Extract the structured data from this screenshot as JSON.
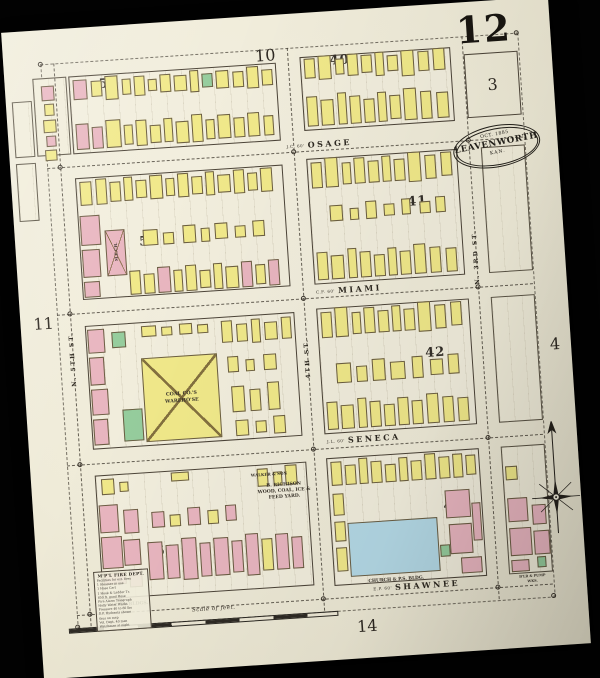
{
  "sheet": {
    "number": "12",
    "adjacent": {
      "top": "10",
      "top_right": "3",
      "left": "11",
      "right": "4",
      "bottom": "14"
    },
    "stamp": {
      "date": "OCT. 1885",
      "city": "LEAVENWORTH",
      "state": "KAN."
    },
    "scale_label": "Scale of feet."
  },
  "colors": {
    "paper": "#f0ecda",
    "ink": "#3c362d",
    "frame_black": "#020202",
    "building_frame_yellow": "#f1e98a",
    "building_brick_pink": "#e9b6c0",
    "building_special_green": "#96cd9d",
    "building_stone_blue": "#b4d9e6"
  },
  "legend": {
    "title": "M'P'L FIRE DEPT.",
    "lines": [
      "Facilities for ext. fires",
      "1 Steamer in use",
      "1 Hose Cart",
      "1 Hook & Ladder Tr.",
      "850 ft. good Hose",
      "Fire Alarm Telegraph",
      "Holly Water Works",
      "Pressure 40 to 80 lbs",
      "D.P. Hydrants shown",
      "thus on map",
      "Vol. Dept. 40 men",
      "Watchman at night"
    ]
  },
  "streets": {
    "horizontal": [
      {
        "name": "OSAGE",
        "prefix": "J.C. 60'",
        "cx": 310,
        "cy": 132,
        "y": 138
      },
      {
        "name": "MIAMI",
        "prefix": "C.F. 60'",
        "cx": 330,
        "cy": 279,
        "y": 285
      },
      {
        "name": "SENECA",
        "prefix": "J.L. 60'",
        "cx": 335,
        "cy": 429,
        "y": 436
      },
      {
        "name": "SHAWNEE",
        "prefix": "E.P. 60'",
        "cx": 378,
        "cy": 579,
        "y": 586
      }
    ],
    "vertical": [
      {
        "name": "N. 5TH ST.",
        "x": 50,
        "cy": 330
      },
      {
        "name": "4TH ST.",
        "x": 284,
        "cy": 345
      },
      {
        "name": "N. 3RD ST.",
        "x": 459,
        "cy": 255
      }
    ]
  },
  "blocks": [
    {
      "n": "53",
      "x": 64,
      "y": 48,
      "w": 208,
      "h": 78,
      "nx": 104,
      "ny": 58
    },
    {
      "n": "40",
      "x": 296,
      "y": 44,
      "w": 151,
      "h": 74,
      "nx": 336,
      "ny": 50
    },
    {
      "n": "52",
      "x": 64,
      "y": 150,
      "w": 208,
      "h": 122,
      "nx": 134,
      "ny": 218
    },
    {
      "n": "41",
      "x": 296,
      "y": 146,
      "w": 151,
      "h": 126,
      "nx": 404,
      "ny": 196
    },
    {
      "n": "51",
      "x": 64,
      "y": 298,
      "w": 210,
      "h": 124,
      "nx": 130,
      "ny": 378
    },
    {
      "n": "42",
      "x": 296,
      "y": 296,
      "w": 153,
      "h": 126,
      "nx": 412,
      "ny": 348
    },
    {
      "n": "50",
      "x": 64,
      "y": 448,
      "w": 212,
      "h": 124,
      "nx": 130,
      "ny": 528
    },
    {
      "n": "43",
      "x": 296,
      "y": 446,
      "w": 153,
      "h": 128,
      "nx": 420,
      "ny": 502
    }
  ],
  "partial_blocks": [
    {
      "x": 471,
      "y": 146,
      "w": 44,
      "h": 126
    },
    {
      "x": 471,
      "y": 296,
      "w": 44,
      "h": 126
    },
    {
      "x": 471,
      "y": 446,
      "w": 44,
      "h": 128
    },
    {
      "x": 28,
      "y": 48,
      "w": 34,
      "h": 78
    },
    {
      "x": 6,
      "y": 70,
      "w": 20,
      "h": 56
    },
    {
      "x": 6,
      "y": 132,
      "w": 20,
      "h": 58
    }
  ],
  "buildings": [
    [
      36,
      56,
      13,
      15,
      "p"
    ],
    [
      38,
      74,
      10,
      12,
      "y"
    ],
    [
      36,
      90,
      13,
      13,
      "y"
    ],
    [
      38,
      106,
      10,
      11,
      "p"
    ],
    [
      36,
      120,
      12,
      11,
      "y"
    ],
    [
      68,
      52,
      14,
      20,
      "p"
    ],
    [
      86,
      54,
      11,
      16,
      "y"
    ],
    [
      100,
      50,
      13,
      24,
      "y"
    ],
    [
      117,
      54,
      9,
      16,
      "y"
    ],
    [
      129,
      52,
      11,
      20,
      "y"
    ],
    [
      143,
      56,
      9,
      12,
      "y"
    ],
    [
      155,
      52,
      11,
      18,
      "y"
    ],
    [
      169,
      54,
      13,
      16,
      "y"
    ],
    [
      185,
      50,
      9,
      22,
      "y"
    ],
    [
      197,
      54,
      11,
      14,
      "g"
    ],
    [
      211,
      52,
      13,
      18,
      "y"
    ],
    [
      228,
      54,
      11,
      16,
      "y"
    ],
    [
      242,
      50,
      12,
      22,
      "y"
    ],
    [
      257,
      54,
      11,
      16,
      "y"
    ],
    [
      68,
      96,
      13,
      26,
      "p"
    ],
    [
      84,
      100,
      11,
      22,
      "p"
    ],
    [
      98,
      94,
      15,
      28,
      "y"
    ],
    [
      116,
      100,
      9,
      20,
      "y"
    ],
    [
      128,
      96,
      11,
      26,
      "y"
    ],
    [
      142,
      102,
      11,
      18,
      "y"
    ],
    [
      156,
      96,
      9,
      24,
      "y"
    ],
    [
      168,
      100,
      13,
      22,
      "y"
    ],
    [
      184,
      94,
      11,
      28,
      "y"
    ],
    [
      198,
      100,
      9,
      20,
      "y"
    ],
    [
      210,
      96,
      13,
      24,
      "y"
    ],
    [
      226,
      100,
      11,
      20,
      "y"
    ],
    [
      240,
      96,
      12,
      24,
      "y"
    ],
    [
      256,
      100,
      10,
      20,
      "y"
    ],
    [
      300,
      46,
      11,
      20,
      "y"
    ],
    [
      314,
      44,
      13,
      24,
      "y"
    ],
    [
      331,
      48,
      9,
      16,
      "y"
    ],
    [
      343,
      44,
      11,
      22,
      "y"
    ],
    [
      357,
      46,
      11,
      18,
      "y"
    ],
    [
      371,
      44,
      9,
      24,
      "y"
    ],
    [
      383,
      48,
      11,
      16,
      "y"
    ],
    [
      397,
      44,
      13,
      26,
      "y"
    ],
    [
      414,
      46,
      11,
      20,
      "y"
    ],
    [
      429,
      44,
      12,
      22,
      "y"
    ],
    [
      300,
      84,
      11,
      30,
      "y"
    ],
    [
      314,
      88,
      13,
      26,
      "y"
    ],
    [
      331,
      82,
      9,
      32,
      "y"
    ],
    [
      343,
      86,
      11,
      28,
      "y"
    ],
    [
      357,
      90,
      11,
      24,
      "y"
    ],
    [
      371,
      84,
      9,
      30,
      "y"
    ],
    [
      383,
      88,
      11,
      24,
      "y"
    ],
    [
      397,
      82,
      13,
      32,
      "y"
    ],
    [
      414,
      86,
      11,
      28,
      "y"
    ],
    [
      430,
      88,
      12,
      26,
      "y"
    ],
    [
      68,
      154,
      12,
      24,
      "y"
    ],
    [
      84,
      152,
      11,
      26,
      "y"
    ],
    [
      98,
      156,
      11,
      20,
      "y"
    ],
    [
      112,
      152,
      9,
      24,
      "y"
    ],
    [
      124,
      156,
      11,
      18,
      "y"
    ],
    [
      138,
      152,
      13,
      24,
      "y"
    ],
    [
      154,
      156,
      9,
      18,
      "y"
    ],
    [
      166,
      152,
      11,
      24,
      "y"
    ],
    [
      180,
      156,
      11,
      18,
      "y"
    ],
    [
      194,
      152,
      9,
      24,
      "y"
    ],
    [
      206,
      156,
      13,
      18,
      "y"
    ],
    [
      222,
      152,
      11,
      24,
      "y"
    ],
    [
      236,
      156,
      10,
      18,
      "y"
    ],
    [
      249,
      152,
      12,
      24,
      "y"
    ],
    [
      66,
      188,
      20,
      30,
      "p"
    ],
    [
      66,
      222,
      18,
      28,
      "p"
    ],
    [
      66,
      254,
      16,
      16,
      "p"
    ],
    [
      90,
      204,
      20,
      46,
      "p",
      1
    ],
    [
      112,
      246,
      11,
      24,
      "y"
    ],
    [
      126,
      250,
      11,
      20,
      "y"
    ],
    [
      140,
      244,
      13,
      26,
      "p"
    ],
    [
      156,
      248,
      9,
      22,
      "y"
    ],
    [
      168,
      244,
      11,
      26,
      "y"
    ],
    [
      182,
      250,
      11,
      18,
      "y"
    ],
    [
      196,
      244,
      9,
      26,
      "y"
    ],
    [
      208,
      248,
      13,
      22,
      "y"
    ],
    [
      224,
      244,
      11,
      26,
      "p"
    ],
    [
      238,
      248,
      10,
      20,
      "y"
    ],
    [
      251,
      244,
      11,
      26,
      "p"
    ],
    [
      128,
      206,
      15,
      16,
      "y"
    ],
    [
      148,
      210,
      11,
      12,
      "y"
    ],
    [
      168,
      204,
      13,
      18,
      "y"
    ],
    [
      186,
      208,
      9,
      14,
      "y"
    ],
    [
      200,
      204,
      13,
      16,
      "y"
    ],
    [
      220,
      208,
      11,
      12,
      "y"
    ],
    [
      238,
      204,
      12,
      16,
      "y"
    ],
    [
      300,
      150,
      11,
      26,
      "y"
    ],
    [
      314,
      146,
      13,
      30,
      "y"
    ],
    [
      331,
      152,
      9,
      22,
      "y"
    ],
    [
      343,
      148,
      11,
      26,
      "y"
    ],
    [
      357,
      152,
      11,
      22,
      "y"
    ],
    [
      371,
      148,
      9,
      26,
      "y"
    ],
    [
      383,
      152,
      11,
      22,
      "y"
    ],
    [
      397,
      146,
      13,
      30,
      "y"
    ],
    [
      414,
      150,
      11,
      24,
      "y"
    ],
    [
      430,
      148,
      11,
      24,
      "y"
    ],
    [
      300,
      240,
      11,
      28,
      "y"
    ],
    [
      314,
      244,
      13,
      24,
      "y"
    ],
    [
      331,
      238,
      9,
      30,
      "y"
    ],
    [
      343,
      242,
      11,
      26,
      "y"
    ],
    [
      357,
      246,
      11,
      22,
      "y"
    ],
    [
      371,
      240,
      9,
      28,
      "y"
    ],
    [
      383,
      244,
      11,
      24,
      "y"
    ],
    [
      397,
      238,
      12,
      30,
      "y"
    ],
    [
      413,
      242,
      11,
      26,
      "y"
    ],
    [
      429,
      244,
      11,
      24,
      "y"
    ],
    [
      316,
      194,
      13,
      16,
      "y"
    ],
    [
      336,
      198,
      9,
      12,
      "y"
    ],
    [
      352,
      192,
      11,
      18,
      "y"
    ],
    [
      370,
      196,
      11,
      12,
      "y"
    ],
    [
      388,
      192,
      9,
      16,
      "y"
    ],
    [
      406,
      196,
      11,
      12,
      "y"
    ],
    [
      422,
      192,
      10,
      16,
      "y"
    ],
    [
      118,
      334,
      76,
      84,
      "y",
      1
    ],
    [
      96,
      384,
      20,
      32,
      "g"
    ],
    [
      90,
      306,
      14,
      16,
      "g"
    ],
    [
      66,
      302,
      17,
      24,
      "p"
    ],
    [
      66,
      330,
      15,
      28,
      "p"
    ],
    [
      66,
      362,
      17,
      26,
      "p"
    ],
    [
      66,
      392,
      15,
      26,
      "p"
    ],
    [
      120,
      302,
      15,
      11,
      "y"
    ],
    [
      140,
      304,
      11,
      9,
      "y"
    ],
    [
      158,
      302,
      13,
      11,
      "y"
    ],
    [
      176,
      304,
      11,
      9,
      "y"
    ],
    [
      200,
      302,
      11,
      22,
      "y"
    ],
    [
      215,
      306,
      11,
      18,
      "y"
    ],
    [
      230,
      302,
      9,
      24,
      "y"
    ],
    [
      243,
      306,
      13,
      18,
      "y"
    ],
    [
      260,
      302,
      10,
      22,
      "y"
    ],
    [
      204,
      338,
      11,
      16,
      "y"
    ],
    [
      222,
      342,
      9,
      12,
      "y"
    ],
    [
      240,
      338,
      13,
      16,
      "y"
    ],
    [
      206,
      368,
      13,
      26,
      "y"
    ],
    [
      224,
      372,
      11,
      22,
      "y"
    ],
    [
      242,
      366,
      12,
      28,
      "y"
    ],
    [
      208,
      402,
      13,
      16,
      "y"
    ],
    [
      228,
      404,
      11,
      12,
      "y"
    ],
    [
      246,
      400,
      12,
      18,
      "y"
    ],
    [
      300,
      300,
      11,
      26,
      "y"
    ],
    [
      314,
      296,
      13,
      30,
      "y"
    ],
    [
      331,
      302,
      9,
      22,
      "y"
    ],
    [
      343,
      298,
      11,
      26,
      "y"
    ],
    [
      357,
      302,
      11,
      22,
      "y"
    ],
    [
      371,
      298,
      9,
      26,
      "y"
    ],
    [
      383,
      302,
      11,
      22,
      "y"
    ],
    [
      397,
      296,
      13,
      30,
      "y"
    ],
    [
      414,
      300,
      11,
      24,
      "y"
    ],
    [
      430,
      298,
      11,
      24,
      "y"
    ],
    [
      312,
      352,
      15,
      20,
      "y"
    ],
    [
      332,
      356,
      11,
      16,
      "y"
    ],
    [
      348,
      350,
      13,
      22,
      "y"
    ],
    [
      366,
      354,
      15,
      18,
      "y"
    ],
    [
      388,
      350,
      11,
      22,
      "y"
    ],
    [
      406,
      354,
      13,
      16,
      "y"
    ],
    [
      424,
      350,
      11,
      20,
      "y"
    ],
    [
      300,
      390,
      11,
      28,
      "y"
    ],
    [
      314,
      394,
      13,
      24,
      "y"
    ],
    [
      331,
      388,
      9,
      30,
      "y"
    ],
    [
      343,
      392,
      11,
      26,
      "y"
    ],
    [
      357,
      396,
      11,
      22,
      "y"
    ],
    [
      371,
      390,
      11,
      28,
      "y"
    ],
    [
      385,
      394,
      11,
      24,
      "y"
    ],
    [
      400,
      388,
      12,
      30,
      "y"
    ],
    [
      416,
      392,
      11,
      26,
      "y"
    ],
    [
      431,
      394,
      11,
      24,
      "y"
    ],
    [
      70,
      452,
      13,
      16,
      "y"
    ],
    [
      88,
      456,
      9,
      10,
      "y"
    ],
    [
      140,
      450,
      18,
      9,
      "y"
    ],
    [
      226,
      452,
      11,
      18,
      "y"
    ],
    [
      242,
      456,
      9,
      14,
      "y"
    ],
    [
      254,
      450,
      12,
      20,
      "y"
    ],
    [
      66,
      478,
      19,
      28,
      "p"
    ],
    [
      66,
      510,
      21,
      32,
      "p"
    ],
    [
      90,
      484,
      15,
      24,
      "p"
    ],
    [
      88,
      514,
      17,
      26,
      "p"
    ],
    [
      66,
      546,
      23,
      12,
      "p"
    ],
    [
      92,
      544,
      13,
      18,
      "p"
    ],
    [
      118,
      488,
      13,
      16,
      "p"
    ],
    [
      136,
      492,
      11,
      12,
      "y"
    ],
    [
      154,
      486,
      13,
      18,
      "p"
    ],
    [
      174,
      490,
      11,
      14,
      "y"
    ],
    [
      192,
      486,
      11,
      16,
      "p"
    ],
    [
      112,
      518,
      15,
      38,
      "p"
    ],
    [
      130,
      522,
      13,
      34,
      "p"
    ],
    [
      146,
      516,
      15,
      42,
      "p"
    ],
    [
      164,
      522,
      11,
      34,
      "p"
    ],
    [
      178,
      518,
      15,
      38,
      "p"
    ],
    [
      196,
      522,
      11,
      32,
      "p"
    ],
    [
      210,
      516,
      13,
      42,
      "p"
    ],
    [
      226,
      522,
      11,
      32,
      "y"
    ],
    [
      240,
      518,
      13,
      36,
      "p"
    ],
    [
      256,
      522,
      11,
      32,
      "p"
    ],
    [
      300,
      450,
      11,
      24,
      "y"
    ],
    [
      314,
      454,
      11,
      20,
      "y"
    ],
    [
      328,
      448,
      9,
      26,
      "y"
    ],
    [
      340,
      452,
      11,
      22,
      "y"
    ],
    [
      354,
      456,
      11,
      18,
      "y"
    ],
    [
      368,
      450,
      9,
      24,
      "y"
    ],
    [
      380,
      454,
      11,
      20,
      "y"
    ],
    [
      394,
      448,
      11,
      26,
      "y"
    ],
    [
      408,
      452,
      11,
      22,
      "y"
    ],
    [
      422,
      450,
      10,
      24,
      "y"
    ],
    [
      435,
      452,
      10,
      20,
      "y"
    ],
    [
      300,
      482,
      11,
      22,
      "y"
    ],
    [
      300,
      510,
      11,
      20,
      "y"
    ],
    [
      300,
      536,
      11,
      24,
      "y"
    ],
    [
      313,
      512,
      90,
      54,
      "b"
    ],
    [
      412,
      486,
      25,
      28,
      "p"
    ],
    [
      414,
      520,
      23,
      30,
      "p"
    ],
    [
      438,
      500,
      9,
      38,
      "p"
    ],
    [
      424,
      554,
      21,
      16,
      "p"
    ],
    [
      404,
      540,
      10,
      12,
      "g"
    ],
    [
      474,
      466,
      12,
      14,
      "y"
    ],
    [
      474,
      498,
      20,
      24,
      "p"
    ],
    [
      474,
      528,
      22,
      28,
      "p"
    ],
    [
      498,
      506,
      14,
      20,
      "p"
    ],
    [
      498,
      532,
      16,
      24,
      "p"
    ],
    [
      474,
      560,
      18,
      12,
      "p"
    ],
    [
      500,
      558,
      9,
      11,
      "g"
    ]
  ],
  "annotations": [
    {
      "t": "WALKER & SON",
      "x": 238,
      "y": 458,
      "s": 4
    },
    {
      "t": "B. RICHISON",
      "x": 252,
      "y": 470,
      "s": 4.6
    },
    {
      "t": "WOOD, COAL, ICE &",
      "x": 252,
      "y": 476,
      "s": 4.6
    },
    {
      "t": "FEED YARD.",
      "x": 252,
      "y": 482,
      "s": 4.6
    },
    {
      "t": "CITY BLDGS.",
      "x": 92,
      "y": 579,
      "s": 4.6
    },
    {
      "t": "COAL CO.'S",
      "x": 156,
      "y": 372,
      "s": 4.8
    },
    {
      "t": "WAREHO'SE",
      "x": 156,
      "y": 379,
      "s": 4.8
    },
    {
      "t": "M.E.CH.",
      "x": 100,
      "y": 226,
      "s": 4,
      "r": -90
    },
    {
      "t": "CHURCH & P.S. BLDG.",
      "x": 358,
      "y": 572,
      "s": 4.4
    },
    {
      "t": "B'LR & PUMP",
      "x": 494,
      "y": 577,
      "s": 3.4
    },
    {
      "t": "WKS.",
      "x": 494,
      "y": 582,
      "s": 3.4
    }
  ],
  "markers": [
    [
      50,
      138
    ],
    [
      284,
      138
    ],
    [
      459,
      138
    ],
    [
      50,
      285
    ],
    [
      284,
      285
    ],
    [
      459,
      285
    ],
    [
      50,
      436
    ],
    [
      284,
      436
    ],
    [
      459,
      436
    ],
    [
      50,
      586
    ],
    [
      284,
      586
    ],
    [
      459,
      586
    ],
    [
      37,
      34
    ],
    [
      514,
      34
    ],
    [
      37,
      598
    ],
    [
      514,
      598
    ]
  ]
}
